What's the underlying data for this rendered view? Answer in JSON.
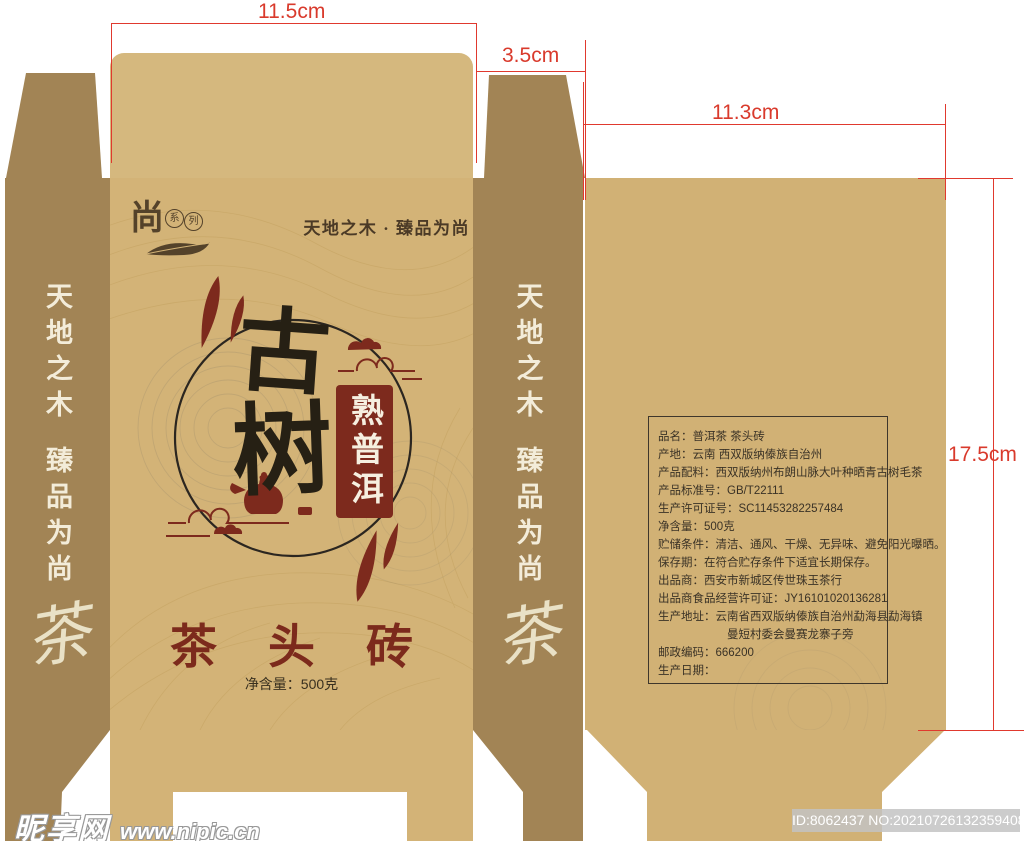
{
  "dimensions": {
    "front_width": "11.5cm",
    "side_width": "3.5cm",
    "back_width": "11.3cm",
    "panel_height": "17.5cm"
  },
  "brand": {
    "logo_char": "尚",
    "series_char_1": "系",
    "series_char_2": "列",
    "tagline": "天地之木 · 臻品为尚"
  },
  "front": {
    "title_char_1": "古",
    "title_char_2": "树",
    "ribbon_text": "熟普洱",
    "product_name": "茶 头 砖",
    "net_weight": "净含量：500克"
  },
  "side_panel": {
    "line1": "天地之木",
    "line2": "臻品为尚",
    "tea_char": "茶"
  },
  "info_table": {
    "rows": [
      {
        "text": "品名：普洱茶  茶头砖"
      },
      {
        "text": "产地：云南 西双版纳傣族自治州"
      },
      {
        "text": "产品配料：西双版纳州布朗山脉大叶种晒青古树毛茶"
      },
      {
        "text": "产品标准号：GB/T22111"
      },
      {
        "text": "生产许可证号：SC11453282257484"
      },
      {
        "text": "净含量：500克"
      },
      {
        "text": "贮储条件：清洁、通风、干燥、无异味、避免阳光曝晒。"
      },
      {
        "text": "保存期：在符合贮存条件下适宜长期保存。"
      },
      {
        "text": "出品商：西安市新城区传世珠玉茶行"
      },
      {
        "text": "出品商食品经营许可证：JY16101020136281"
      },
      {
        "text": "生产地址：云南省西双版纳傣族自治州勐海县勐海镇"
      },
      {
        "text": "曼短村委会曼赛龙寨子旁",
        "indent": true
      },
      {
        "text": "邮政编码：666200"
      },
      {
        "text": "生产日期："
      }
    ]
  },
  "watermark": {
    "site_name": "昵享网",
    "site_url": "www.nipic.cn",
    "id_text": "ID:8062437 NO:20210726132359408100"
  },
  "colors": {
    "front_tan": "#d3b377",
    "side_olive": "#a28455",
    "back_tan": "#d1b175",
    "accent_red": "#7d2a1d",
    "ink_black": "#262014",
    "dimension_red": "#e0392e",
    "cream_text": "#f3ecd9"
  }
}
